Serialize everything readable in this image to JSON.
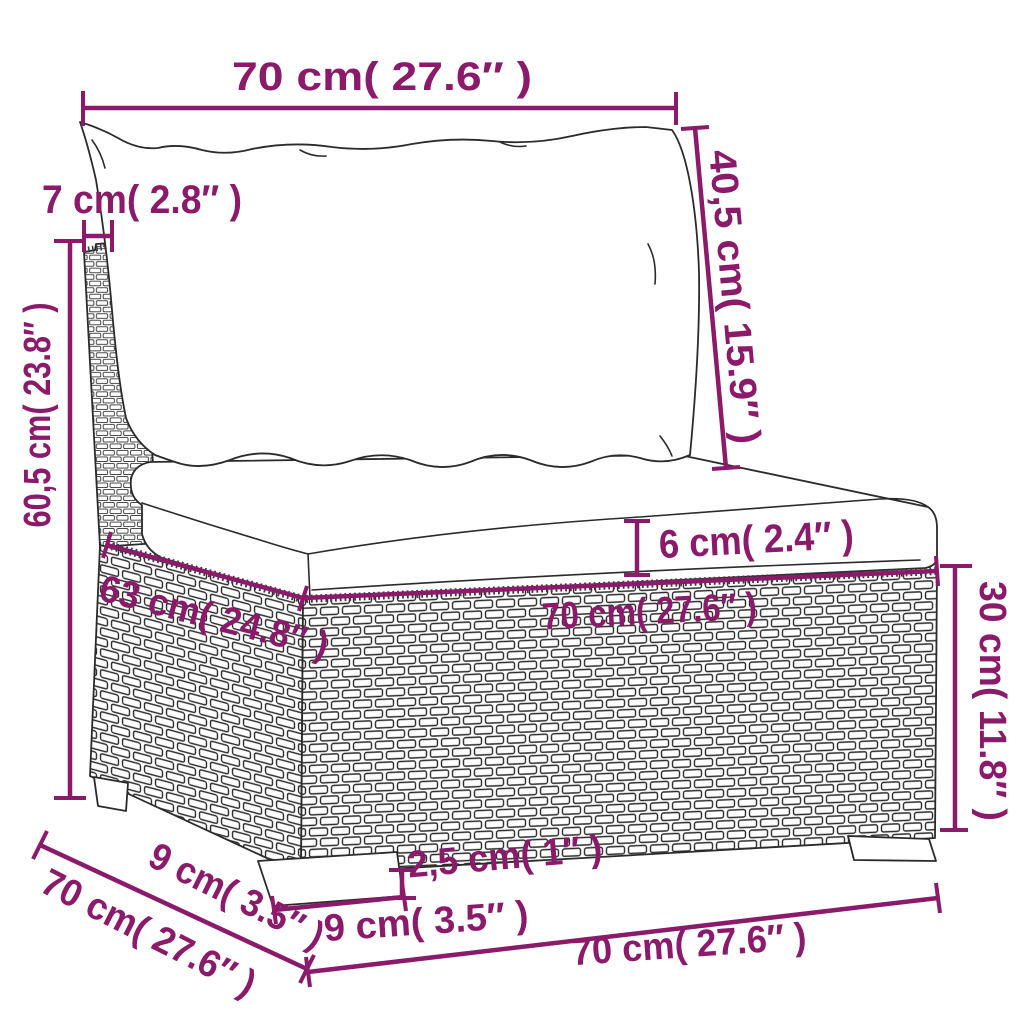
{
  "page": {
    "background": "#ffffff"
  },
  "colors": {
    "dimension": "#8B1A6B",
    "line": "#2B2B2B"
  },
  "drawing": {
    "subject": "poly rattan garden sofa middle section with back cushion and seat cushion, black-and-white line drawing with woven wicker texture"
  },
  "dimensions": {
    "top_width": {
      "label": "70 cm( 27.6″ )"
    },
    "back_thickness": {
      "label": "7 cm( 2.8″ )"
    },
    "back_cushion_height": {
      "label": "40,5 cm( 15.9″ )"
    },
    "total_height": {
      "label": "60,5 cm( 23.8″ )"
    },
    "cushion_thickness": {
      "label": "6 cm( 2.4″ )"
    },
    "seat_depth": {
      "label": "63 cm( 24.8″ )"
    },
    "seat_width": {
      "label": "70 cm( 27.6″ )"
    },
    "base_height": {
      "label": "30 cm( 11.8″ )"
    },
    "leg_height": {
      "label": "2,5 cm( 1″ )"
    },
    "leg_width": {
      "label": "9 cm( 3.5″ )"
    },
    "leg_depth": {
      "label": "9 cm( 3.5″ )"
    },
    "total_depth": {
      "label": "70 cm( 27.6″ )"
    },
    "total_width": {
      "label": "70 cm( 27.6″ )"
    }
  }
}
